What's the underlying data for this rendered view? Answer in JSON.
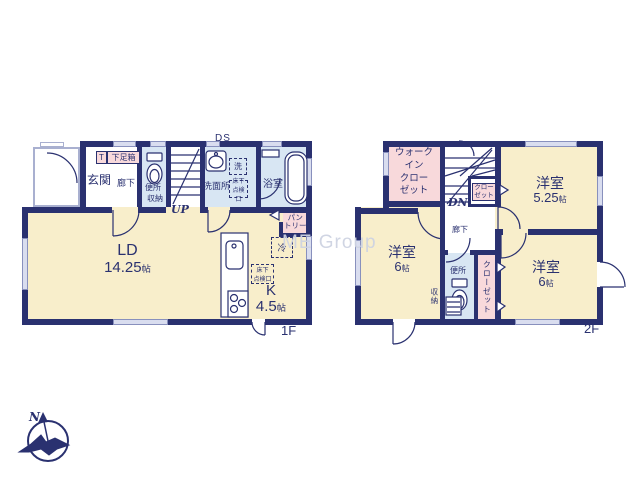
{
  "watermark": "ME Group",
  "compass": {
    "north": "N"
  },
  "floor1": {
    "floor_label": "1F",
    "duct": "DS",
    "stairs": "UP",
    "entrance": {
      "label": "玄関",
      "t": "T",
      "shoe_box": "下足箱"
    },
    "hallway": "廊下",
    "toilet": {
      "label": "便所",
      "storage": "収納"
    },
    "washroom": {
      "label": "洗面所",
      "washer": "洗"
    },
    "hatch": {
      "line1": "床下",
      "line2": "点検口"
    },
    "bathroom": "浴室",
    "pantry": {
      "line1": "パン",
      "line2": "トリー"
    },
    "fridge": "冷",
    "living": {
      "label": "LD",
      "num": "14.25",
      "unit": "帖"
    },
    "kitchen": {
      "label": "K",
      "num": "4.5",
      "unit": "帖"
    }
  },
  "floor2": {
    "floor_label": "2F",
    "stairs": "DN",
    "wic": {
      "line1": "ウォーク",
      "line2": "イン",
      "line3": "クロー",
      "line4": "ゼット"
    },
    "closet_upper": {
      "line1": "クロー",
      "line2": "ゼット"
    },
    "hallway": "廊下",
    "toilet": {
      "label": "便所",
      "storage": "収納"
    },
    "closet_vertical": "クローゼット",
    "room_a": {
      "label": "洋室",
      "num": "5.25",
      "unit": "帖"
    },
    "room_b": {
      "label": "洋室",
      "num": "6",
      "unit": "帖"
    },
    "room_c": {
      "label": "洋室",
      "num": "6",
      "unit": "帖"
    }
  }
}
